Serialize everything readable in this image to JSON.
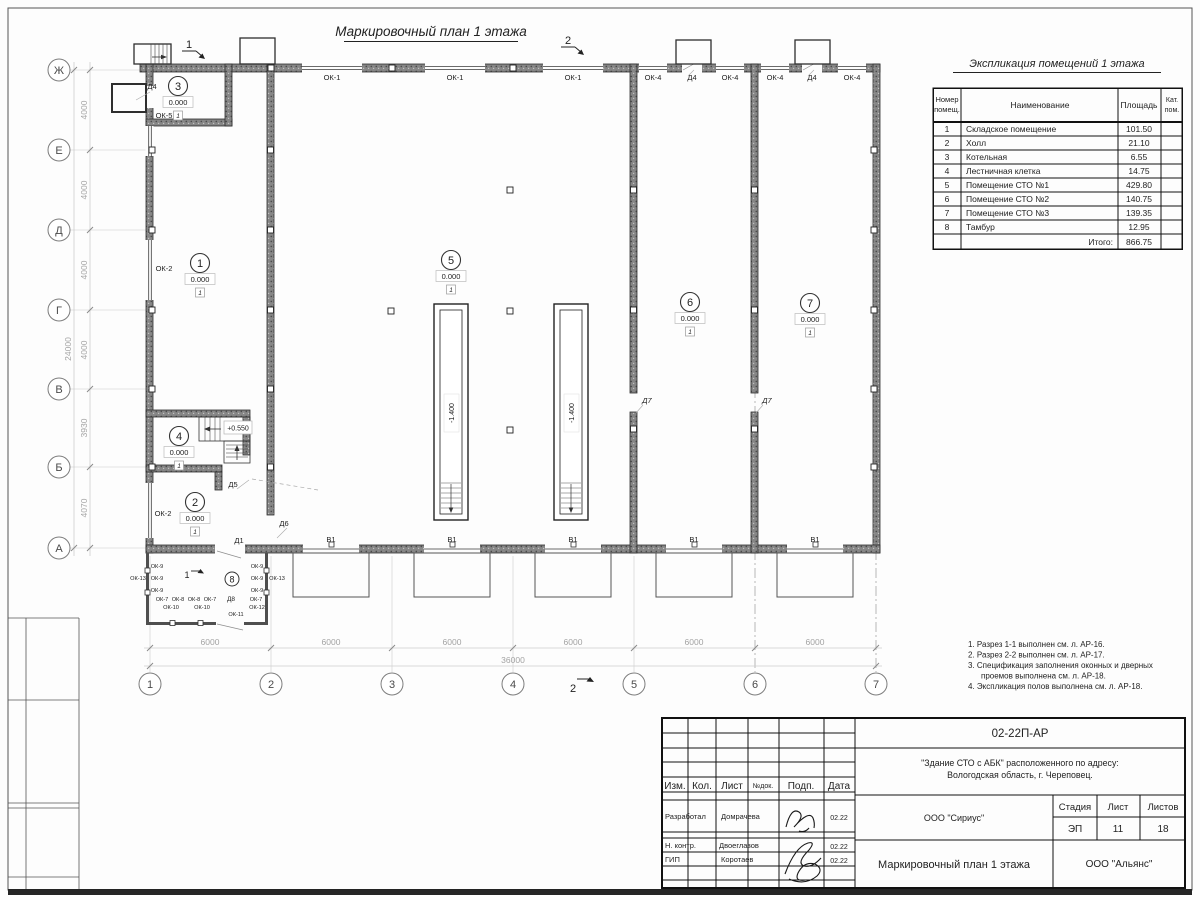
{
  "plan": {
    "title": "Маркировочный план 1 этажа",
    "rooms": {
      "r1": "1",
      "r2": "2",
      "r3": "3",
      "r4": "4",
      "r5": "5",
      "r6": "6",
      "r7": "7",
      "r8": "8"
    },
    "elev_zero": "0.000",
    "floor_mark": "1",
    "elev_stair": "+0.550",
    "pit_depth": "-1.400",
    "axis_letters": [
      "Ж",
      "Е",
      "Д",
      "Г",
      "В",
      "Б",
      "А"
    ],
    "axis_numbers": [
      "1",
      "2",
      "3",
      "4",
      "5",
      "6",
      "7"
    ],
    "dims_left": [
      "4000",
      "4000",
      "4000",
      "4000",
      "3930",
      "4070"
    ],
    "dim_left_total": "24000",
    "dim_bay": "6000",
    "dim_total": "36000",
    "sec1": "1",
    "sec2": "2",
    "labels": {
      "ok1": "ОК-1",
      "ok2": "ОК-2",
      "ok4": "ОК-4",
      "ok5": "ОК-5",
      "ok7": "ОК-7",
      "ok8": "ОК-8",
      "ok9": "ОК-9",
      "ok10": "ОК-10",
      "ok11": "ОК-11",
      "ok12": "ОК-12",
      "ok13": "ОК-13",
      "d1": "Д1",
      "d4": "Д4",
      "d5": "Д5",
      "d6": "Д6",
      "d7": "Д7",
      "d8": "Д8",
      "v1": "В1"
    }
  },
  "explication": {
    "title": "Экспликация помещений 1 этажа",
    "col_num_1": "Номер",
    "col_num_2": "помещ.",
    "col_name": "Наименование",
    "col_area": "Площадь",
    "col_cat_1": "Кат.",
    "col_cat_2": "пом.",
    "rows": [
      {
        "num": "1",
        "name": "Складское помещение",
        "area": "101.50"
      },
      {
        "num": "2",
        "name": "Холл",
        "area": "21.10"
      },
      {
        "num": "3",
        "name": "Котельная",
        "area": "6.55"
      },
      {
        "num": "4",
        "name": "Лестничная клетка",
        "area": "14.75"
      },
      {
        "num": "5",
        "name": "Помещение СТО №1",
        "area": "429.80"
      },
      {
        "num": "6",
        "name": "Помещение СТО №2",
        "area": "140.75"
      },
      {
        "num": "7",
        "name": "Помещение СТО №3",
        "area": "139.35"
      },
      {
        "num": "8",
        "name": "Тамбур",
        "area": "12.95"
      }
    ],
    "total_label": "Итого:",
    "total_value": "866.75"
  },
  "notes": {
    "n1": "1. Разрез 1-1 выполнен см. л. АР-16.",
    "n2": "2. Разрез 2-2 выполнен см. л. АР-17.",
    "n3a": "3. Спецификация заполнения оконных и дверных",
    "n3b": "проемов выполнена см. л. АР-18.",
    "n4": "4. Экспликация полов выполнена см. л. АР-18."
  },
  "titleblock": {
    "doc_number": "02-22П-АР",
    "project_line1": "\"Здание СТО с АБК\" расположенного по адресу:",
    "project_line2": "Вологодская область, г. Череповец.",
    "col_izm": "Изм.",
    "col_kol": "Кол.",
    "col_list": "Лист",
    "col_doc": "№док.",
    "col_podp": "Подп.",
    "col_data": "Дата",
    "row1_role": "Разработал",
    "row1_name": "Домрачева",
    "row1_date": "02.22",
    "row2_role": "Н. контр.",
    "row2_name": "Двоеглазов",
    "row2_date": "02.22",
    "row3_role": "ГИП",
    "row3_name": "Коротаев",
    "row3_date": "02.22",
    "org1": "ООО \"Сириус\"",
    "stage_label": "Стадия",
    "list_label": "Лист",
    "listov_label": "Листов",
    "stage": "ЭП",
    "list": "11",
    "listov": "18",
    "drawing_title": "Маркировочный план 1 этажа",
    "org2": "ООО \"Альянс\""
  }
}
